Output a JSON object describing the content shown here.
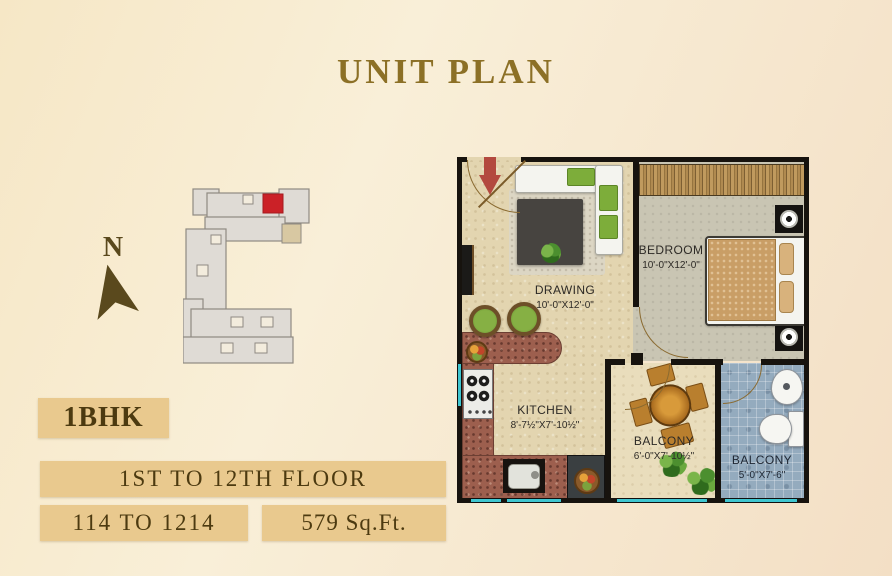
{
  "page": {
    "title": "UNIT PLAN",
    "accent_gold": "#8c7026",
    "background": "#f7e9cc"
  },
  "compass": {
    "north_label": "N",
    "arrow_color": "#5a491d"
  },
  "key_plan": {
    "building_fill": "#dfdbd5",
    "building_outline": "#8f8a82",
    "highlight_color": "#cb2127",
    "lift_fill": "#d8c8a2"
  },
  "unit_info": {
    "type": "1BHK",
    "floors": "1ST TO 12TH FLOOR",
    "units": "114 TO 1214",
    "area": "579 Sq.Ft.",
    "box_color": "#e9c98e",
    "text_color": "#4c3a10"
  },
  "floor_plan": {
    "entry_arrow_color": "#b3493f",
    "window_color": "#3fc6d0",
    "rooms": [
      {
        "name": "DRAWING",
        "dimensions": "10'-0\"X12'-0\""
      },
      {
        "name": "BEDROOM",
        "dimensions": "10'-0\"X12'-0\""
      },
      {
        "name": "KITCHEN",
        "dimensions": "8'-7½\"X7'-10½\""
      },
      {
        "name": "BALCONY",
        "dimensions": "6'-0\"X7'-10½\""
      },
      {
        "name": "BALCONY",
        "dimensions": "5'-0\"X7'-6\""
      }
    ]
  }
}
